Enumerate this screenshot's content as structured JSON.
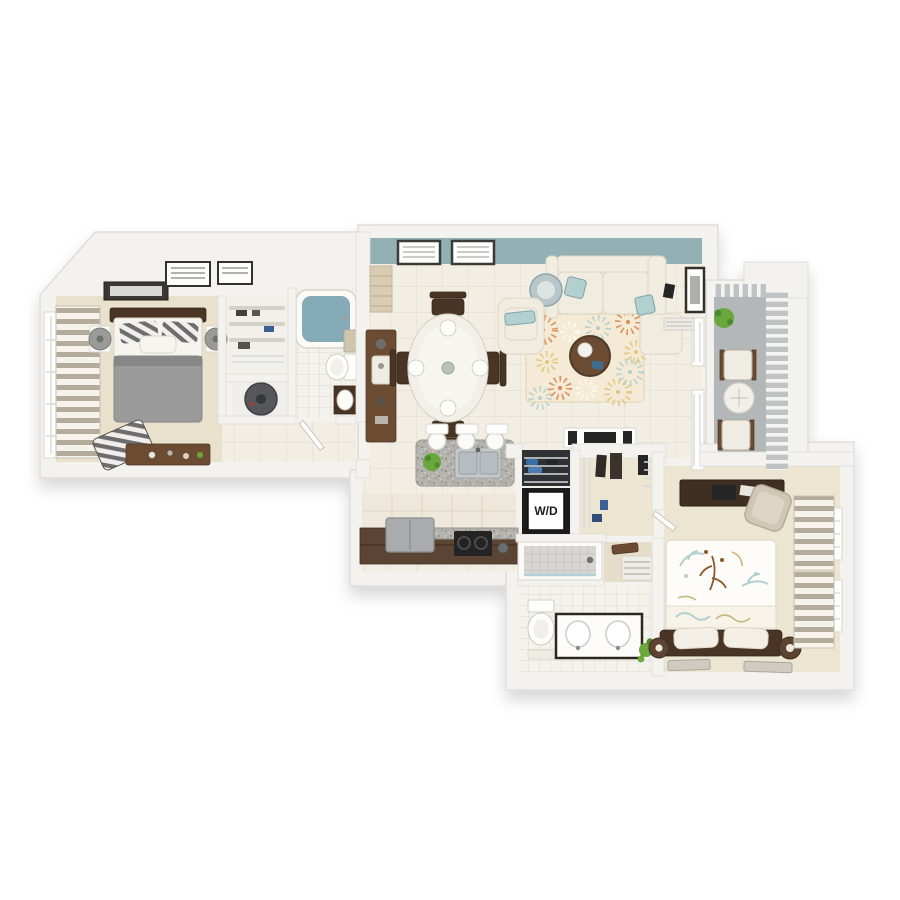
{
  "labels": {
    "washer_dryer": "W/D"
  },
  "palette": {
    "background": "#ffffff",
    "wall": "#f3f2ef",
    "wall_edge": "#dfddd7",
    "teal_accent": "#93b1b4",
    "tile_floor": "#f2eee4",
    "tile_grout": "#e4ded0",
    "bath_tile": "#f4f2ec",
    "bath_grout": "#ddd9ce",
    "carpet": "#e9e1cc",
    "carpet2": "#ece5d2",
    "hall_beige": "#e6ddc8",
    "wood_dark": "#4a3524",
    "wood_brown": "#6b4c33",
    "counter_brown": "#5b4433",
    "granite_base": "#b5b3ad",
    "granite_dark": "#8e8c86",
    "granite_light": "#d9d8d4",
    "water": "#85aab8",
    "duvet_gray": "#9b9b9b",
    "duvet_gray_dark": "#878787",
    "sofa_cream": "#f0ecdf",
    "sofa_edge": "#dcd6c4",
    "rug_cream": "#f4ead6",
    "rug_edge": "#e8dcc2",
    "rug_orange": "#d78b53",
    "rug_yellow": "#e2c77b",
    "rug_teal": "#b3d0d0",
    "balcony_floor": "#b4b7b7",
    "rail_base": "#c0c3c3",
    "appliance_dark": "#262626",
    "stainless": "#c3c8ca",
    "plant_green": "#68a83d",
    "plant_dark": "#4d8a2a",
    "curtain_taupe": "#b3ac9a",
    "curtain_white": "#f5f3ec",
    "lamp_gray": "#9a9a97",
    "lamp_brown": "#5d4330",
    "glass": "#f1efe8",
    "wd_text": "#1c1c1c"
  },
  "scene": {
    "view": "3d-top-down-apartment-floor-plan",
    "accent_wall": "teal on living room top wall",
    "rooms": [
      {
        "name": "bedroom-1",
        "furniture": [
          "bed-gray-duvet",
          "striped-pillows",
          "nightstand-lamps",
          "striped-chaise",
          "dresser",
          "striped-window-curtains",
          "wall-art-frames"
        ]
      },
      {
        "name": "walk-in-closet-1",
        "furniture": [
          "shelving-unit"
        ]
      },
      {
        "name": "utility-closet",
        "furniture": [
          "water-heater"
        ]
      },
      {
        "name": "bathroom-1",
        "furniture": [
          "bathtub",
          "toilet",
          "vanity-sink",
          "towels"
        ]
      },
      {
        "name": "hallway-1",
        "furniture": [
          "open-door"
        ]
      },
      {
        "name": "living-room",
        "furniture": [
          "sectional-sofa",
          "teal-accent-pillows",
          "armchair",
          "floral-area-rug",
          "round-coffee-table",
          "floor-vase",
          "tv-console",
          "wall-frames",
          "window-blinds",
          "entry-steps"
        ]
      },
      {
        "name": "dining-area",
        "furniture": [
          "oval-glass-table",
          "place-settings",
          "four-wood-chairs",
          "sideboard"
        ]
      },
      {
        "name": "kitchen",
        "furniture": [
          "granite-island",
          "double-sink",
          "bar-stools",
          "pendant-lights",
          "potted-plant",
          "refrigerator",
          "cooktop",
          "wood-counter"
        ]
      },
      {
        "name": "laundry-closet",
        "furniture": [
          "stacked-washer-dryer",
          "wire-shelves"
        ]
      },
      {
        "name": "walk-in-closet-2",
        "furniture": [
          "hanging-clothes",
          "wire-shelving",
          "bench"
        ]
      },
      {
        "name": "bathroom-2",
        "furniture": [
          "walk-in-shower",
          "toilet",
          "double-vanity",
          "plant",
          "linen-shelves"
        ]
      },
      {
        "name": "bedroom-2",
        "furniture": [
          "bed-floral-duvet",
          "dark-headboard",
          "white-pillows",
          "nightstand-lamps",
          "desk",
          "desk-chair",
          "striped-window-curtains",
          "floor-mats"
        ]
      },
      {
        "name": "balcony",
        "furniture": [
          "patio-chair",
          "patio-chair",
          "round-table",
          "hanging-plant",
          "slat-railing"
        ]
      }
    ]
  }
}
